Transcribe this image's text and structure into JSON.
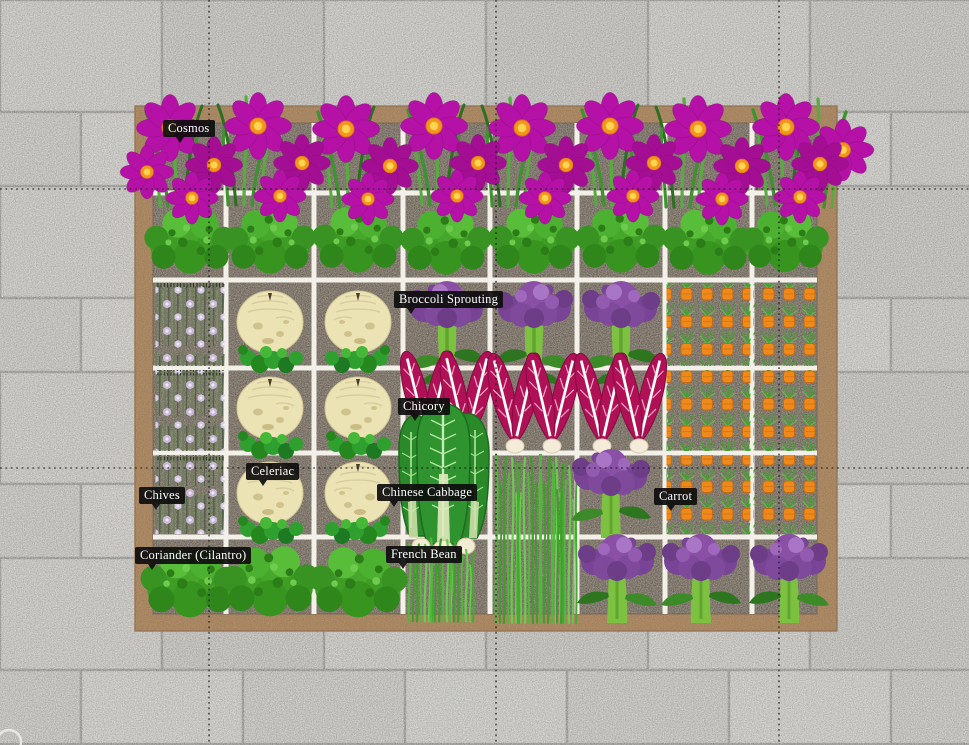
{
  "view": {
    "app_type": "garden-planner-plan-view",
    "background": "stone paving",
    "bed": {
      "rows": 6,
      "columns": 8,
      "style": "raised wooden bed with square-foot grid"
    }
  },
  "plant_labels": {
    "cosmos": {
      "text": "Cosmos"
    },
    "broccoli_sprouting": {
      "text": "Broccoli Sprouting"
    },
    "chicory": {
      "text": "Chicory"
    },
    "celeriac": {
      "text": "Celeriac"
    },
    "chinese_cabbage": {
      "text": "Chinese Cabbage"
    },
    "chives": {
      "text": "Chives"
    },
    "carrot": {
      "text": "Carrot"
    },
    "coriander": {
      "text": "Coriander (Cilantro)"
    },
    "french_bean": {
      "text": "French Bean"
    }
  },
  "guides": {
    "vertical_x": [
      209,
      496,
      779
    ],
    "horizontal_y": [
      189,
      468
    ]
  },
  "colors": {
    "paver_base": "#c7c6c1",
    "paver_grout": "#a09f9a",
    "bed_frame": "#b28e68",
    "soil": "#8b8073",
    "grid_line": "#f2f0e8",
    "guide_line": "#161616",
    "label_bg": "#0d0d0d",
    "label_text": "#ffffff",
    "cosmos_petal": "#b511a6",
    "cosmos_petal_alt": "#a30e93",
    "cosmos_center": "#f5941f",
    "cosmos_center_inner": "#ffd44f",
    "bush_green": "#46a72c",
    "chive_stalk": "#6c7f5b",
    "chive_flower": "#c9bad8",
    "celeriac_bulb": "#ece3b4",
    "broccoli_head": "#8a50a6",
    "broccoli_stalk": "#7dc141",
    "chicory_leaf": "#b01055",
    "cabbage_green": "#2f9330",
    "bean_grass": "#52b83b",
    "carrot_top": "#f0891b",
    "carrot_leaf": "#46a033"
  }
}
